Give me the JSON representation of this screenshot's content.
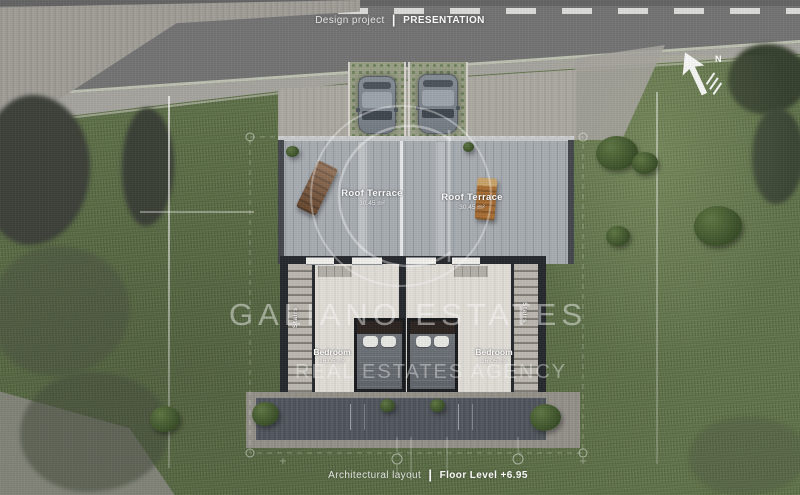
{
  "header": {
    "project_label": "Design project",
    "separator": "|",
    "stage_label": "PRESENTATION"
  },
  "footer": {
    "layout_label": "Architectural layout",
    "separator": "|",
    "level_label": "Floor Level +6.95"
  },
  "compass": {
    "north_label": "N"
  },
  "watermark": {
    "monogram": "G",
    "line1": "GALIANO ESTATES",
    "line2": "REAL ESTATES AGENCY"
  },
  "rooms": {
    "roof_terraces": [
      {
        "name": "Roof Terrace",
        "area": "30.45 m²"
      },
      {
        "name": "Roof Terrace",
        "area": "30.45 m²"
      }
    ],
    "bedrooms": [
      {
        "name": "Bedroom",
        "area": "16.05 m²"
      },
      {
        "name": "Bedroom",
        "area": "16.05 m²"
      }
    ],
    "stairs": [
      {
        "name": "Stairs"
      },
      {
        "name": "Stairs"
      }
    ]
  },
  "colors": {
    "grass": "#61744a",
    "asphalt": "#737373",
    "deck": "#a2a7ad",
    "wall": "#25282c",
    "patio": "#4d525a",
    "label": "#ffffff"
  }
}
